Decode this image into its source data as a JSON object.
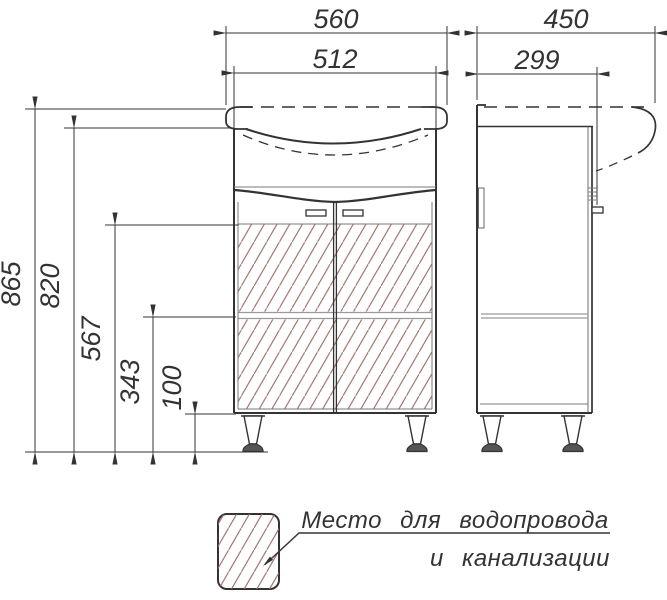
{
  "drawing": {
    "type": "technical-drawing-vanity-cabinet",
    "dimensions": {
      "front": {
        "sink_width": "560",
        "cabinet_width": "512"
      },
      "side": {
        "total_depth": "450",
        "cabinet_depth": "299"
      },
      "heights": {
        "total": "865",
        "to_counter": "820",
        "hatch_top": "567",
        "shelf": "343",
        "plinth": "100"
      }
    },
    "legend": {
      "line1": "Место для водопровода",
      "line2": "и канализации"
    },
    "colors": {
      "line": "#333333",
      "hatch": "#9b6a6a",
      "thin_line": "#7a7a7a"
    }
  }
}
